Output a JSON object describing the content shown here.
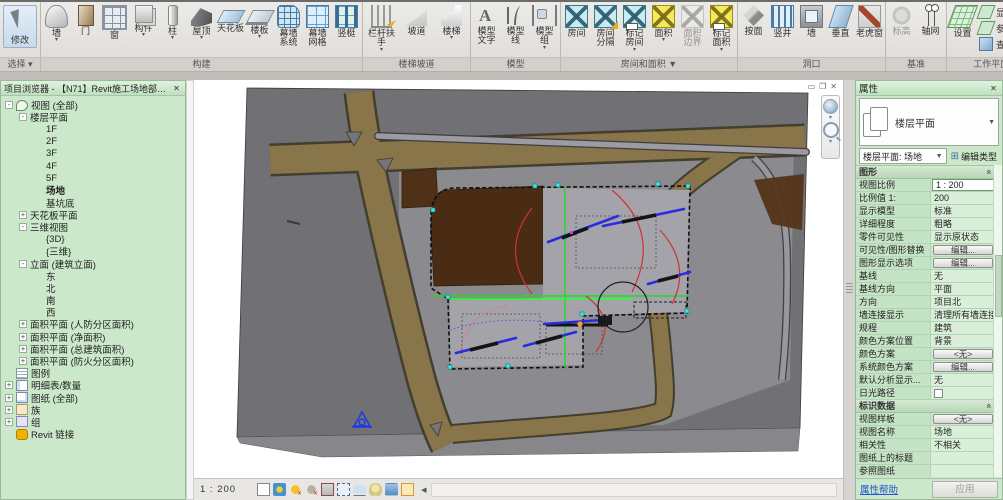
{
  "ribbon": {
    "modify": {
      "label": "修改",
      "group_label": "选择"
    },
    "groups": [
      {
        "label": "构建",
        "buttons": [
          {
            "label": "墙",
            "icon": "wall",
            "caret": true
          },
          {
            "label": "门",
            "icon": "door"
          },
          {
            "label": "窗",
            "icon": "window"
          },
          {
            "label": "构件",
            "icon": "component",
            "caret": true
          },
          {
            "label": "柱",
            "icon": "column",
            "caret": true
          },
          {
            "label": "屋顶",
            "icon": "roof",
            "caret": true
          },
          {
            "label": "天花板",
            "icon": "ceiling"
          },
          {
            "label": "楼板",
            "icon": "floor",
            "caret": true
          },
          {
            "label": "幕墙 系统",
            "icon": "curtain-system"
          },
          {
            "label": "幕墙 网格",
            "icon": "curtain-grid"
          },
          {
            "label": "竖梃",
            "icon": "mullion"
          }
        ]
      },
      {
        "label": "楼梯坡道",
        "buttons": [
          {
            "label": "栏杆扶手",
            "icon": "railing",
            "caret": true
          },
          {
            "label": "坡道",
            "icon": "ramp"
          },
          {
            "label": "楼梯",
            "icon": "stair",
            "caret": true
          }
        ]
      },
      {
        "label": "模型",
        "buttons": [
          {
            "label": "模型 文字",
            "icon": "model-text"
          },
          {
            "label": "模型 线",
            "icon": "model-line"
          },
          {
            "label": "模型 组",
            "icon": "model-group",
            "caret": true
          }
        ]
      },
      {
        "label": "房间和面积 ▼",
        "buttons": [
          {
            "label": "房间",
            "icon": "room"
          },
          {
            "label": "房间 分隔",
            "icon": "room-separator"
          },
          {
            "label": "标记 房间",
            "icon": "tag-room",
            "caret": true
          },
          {
            "label": "面积",
            "icon": "area",
            "caret": true
          },
          {
            "label": "面积 边界",
            "icon": "area-boundary",
            "cls": "disabled"
          },
          {
            "label": "标记 面积",
            "icon": "tag-area",
            "caret": true
          }
        ]
      },
      {
        "label": "洞口",
        "buttons": [
          {
            "label": "按面",
            "icon": "by-face"
          },
          {
            "label": "竖井",
            "icon": "shaft"
          },
          {
            "label": "墙",
            "icon": "wall-opening"
          },
          {
            "label": "垂直",
            "icon": "vertical-opening"
          },
          {
            "label": "老虎窗",
            "icon": "dormer"
          }
        ]
      },
      {
        "label": "基准",
        "buttons": [
          {
            "label": "标高",
            "icon": "level",
            "cls": "disabled"
          },
          {
            "label": "轴网",
            "icon": "grid"
          }
        ]
      },
      {
        "label": "工作平面",
        "buttons": [
          {
            "label": "设置",
            "icon": "set-workplane"
          }
        ],
        "stack": [
          {
            "label": "显示",
            "icon": "show-workplane"
          },
          {
            "label": "参照 平面",
            "icon": "ref-plane"
          },
          {
            "label": "查看器",
            "icon": "viewer"
          }
        ]
      }
    ]
  },
  "browser": {
    "title": "项目浏览器 - 【N71】Revit施工场地部署模型.rvt",
    "tree": [
      {
        "label": "视图 (全部)",
        "lv": "0",
        "e": "-",
        "icon": "views"
      },
      {
        "label": "楼层平面",
        "lv": "1",
        "e": "-",
        "icon": ""
      },
      {
        "label": "1F",
        "lv": "2",
        "e": "",
        "icon": ""
      },
      {
        "label": "2F",
        "lv": "2",
        "e": "",
        "icon": ""
      },
      {
        "label": "3F",
        "lv": "2",
        "e": "",
        "icon": ""
      },
      {
        "label": "4F",
        "lv": "2",
        "e": "",
        "icon": ""
      },
      {
        "label": "5F",
        "lv": "2",
        "e": "",
        "icon": ""
      },
      {
        "label": "场地",
        "lv": "2",
        "e": "",
        "icon": "",
        "cls": "bold"
      },
      {
        "label": "基坑底",
        "lv": "2",
        "e": "",
        "icon": ""
      },
      {
        "label": "天花板平面",
        "lv": "1",
        "e": "+",
        "icon": ""
      },
      {
        "label": "三维视图",
        "lv": "1",
        "e": "-",
        "icon": ""
      },
      {
        "label": "{3D}",
        "lv": "2",
        "e": "",
        "icon": ""
      },
      {
        "label": "{三维}",
        "lv": "2",
        "e": "",
        "icon": ""
      },
      {
        "label": "立面 (建筑立面)",
        "lv": "1",
        "e": "-",
        "icon": ""
      },
      {
        "label": "东",
        "lv": "2",
        "e": "",
        "icon": ""
      },
      {
        "label": "北",
        "lv": "2",
        "e": "",
        "icon": ""
      },
      {
        "label": "南",
        "lv": "2",
        "e": "",
        "icon": ""
      },
      {
        "label": "西",
        "lv": "2",
        "e": "",
        "icon": ""
      },
      {
        "label": "面积平面 (人防分区面积)",
        "lv": "1",
        "e": "+",
        "icon": ""
      },
      {
        "label": "面积平面 (净面积)",
        "lv": "1",
        "e": "+",
        "icon": ""
      },
      {
        "label": "面积平面 (总建筑面积)",
        "lv": "1",
        "e": "+",
        "icon": ""
      },
      {
        "label": "面积平面 (防火分区面积)",
        "lv": "1",
        "e": "+",
        "icon": ""
      },
      {
        "label": "图例",
        "lv": "0",
        "e": "",
        "icon": "legend"
      },
      {
        "label": "明细表/数量",
        "lv": "0",
        "e": "+",
        "icon": "schedule"
      },
      {
        "label": "图纸 (全部)",
        "lv": "0",
        "e": "+",
        "icon": "sheet"
      },
      {
        "label": "族",
        "lv": "0",
        "e": "+",
        "icon": "family"
      },
      {
        "label": "组",
        "lv": "0",
        "e": "+",
        "icon": "group"
      },
      {
        "label": "Revit 链接",
        "lv": "0",
        "e": "",
        "icon": "link"
      }
    ]
  },
  "properties": {
    "title": "属性",
    "type_selector": {
      "label": "楼层平面"
    },
    "instance_selector": {
      "label": "楼层平面: 场地"
    },
    "edit_type_label": "编辑类型",
    "rows": [
      {
        "t": "header",
        "label": "图形"
      },
      {
        "t": "row",
        "label": "视图比例",
        "value": "1 : 200",
        "kind": "editbox"
      },
      {
        "t": "row",
        "label": "比例值 1:",
        "value": "200",
        "cls": "gray"
      },
      {
        "t": "row",
        "label": "显示模型",
        "value": "标准"
      },
      {
        "t": "row",
        "label": "详细程度",
        "value": "粗略"
      },
      {
        "t": "row",
        "label": "零件可见性",
        "value": "显示原状态"
      },
      {
        "t": "row",
        "label": "可见性/图形替换",
        "value": "编辑...",
        "kind": "button"
      },
      {
        "t": "row",
        "label": "图形显示选项",
        "value": "编辑...",
        "kind": "button"
      },
      {
        "t": "row",
        "label": "基线",
        "value": "无"
      },
      {
        "t": "row",
        "label": "基线方向",
        "value": "平面",
        "cls": "gray"
      },
      {
        "t": "row",
        "label": "方向",
        "value": "项目北"
      },
      {
        "t": "row",
        "label": "墙连接显示",
        "value": "清理所有墙连接"
      },
      {
        "t": "row",
        "label": "规程",
        "value": "建筑"
      },
      {
        "t": "row",
        "label": "颜色方案位置",
        "value": "背景"
      },
      {
        "t": "row",
        "label": "颜色方案",
        "value": "<无>",
        "kind": "button"
      },
      {
        "t": "row",
        "label": "系统颜色方案",
        "value": "编辑...",
        "kind": "button"
      },
      {
        "t": "row",
        "label": "默认分析显示...",
        "value": "无"
      },
      {
        "t": "row",
        "label": "日光路径",
        "value": "",
        "kind": "checkbox"
      },
      {
        "t": "header",
        "label": "标识数据"
      },
      {
        "t": "row",
        "label": "视图样板",
        "value": "<无>",
        "kind": "button"
      },
      {
        "t": "row",
        "label": "视图名称",
        "value": "场地"
      },
      {
        "t": "row",
        "label": "相关性",
        "value": "不相关",
        "cls": "gray"
      },
      {
        "t": "row",
        "label": "图纸上的标题",
        "value": ""
      },
      {
        "t": "row",
        "label": "参照图纸",
        "value": "",
        "cls": "gray"
      },
      {
        "t": "row",
        "label": "参照详图",
        "value": "",
        "cls": "gray"
      },
      {
        "t": "header",
        "label": "范围"
      }
    ],
    "help_link": "属性帮助",
    "apply_label": "应用"
  },
  "viewbar": {
    "scale": "1 : 200",
    "icons": [
      {
        "icon": "visual-style"
      },
      {
        "icon": "sun-path"
      },
      {
        "icon": "shadows-on"
      },
      {
        "icon": "shadows-off"
      },
      {
        "icon": "crop-view"
      },
      {
        "icon": "crop-region"
      },
      {
        "icon": "temporary-hide"
      },
      {
        "icon": "reveal-hidden"
      },
      {
        "icon": "rendering"
      },
      {
        "icon": "temporary-view",
        "cls": "active"
      }
    ]
  }
}
